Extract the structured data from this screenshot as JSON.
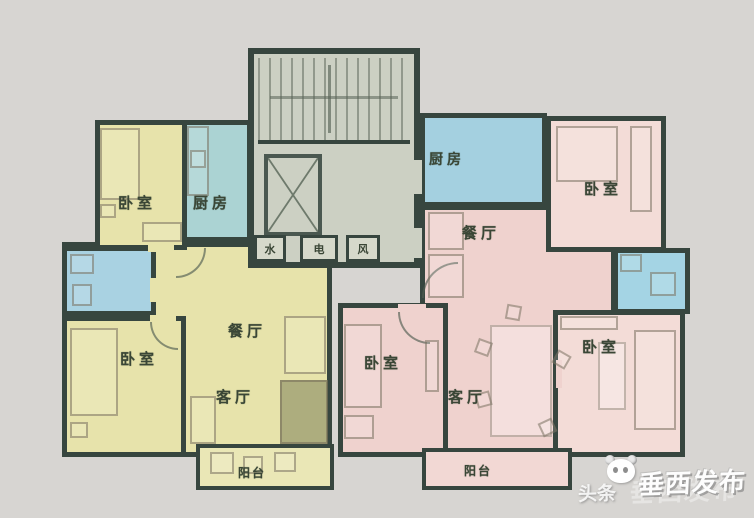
{
  "floorplan": {
    "left_unit": {
      "bedroom_top": "卧室",
      "kitchen": "厨房",
      "bedroom_main": "卧室",
      "dining": "餐厅",
      "living": "客厅",
      "balcony": "阳台"
    },
    "right_unit": {
      "kitchen": "厨房",
      "bedroom_top": "卧室",
      "dining": "餐厅",
      "bedroom_left": "卧室",
      "living": "客厅",
      "bedroom_bottom": "卧室",
      "balcony": "阳台"
    },
    "core": {
      "shaft_water": "水",
      "shaft_electric": "电",
      "shaft_air": "风"
    },
    "watermark": {
      "source": "头条",
      "logo": "panda-icon",
      "name": "垂西发布"
    },
    "colors": {
      "background": "#d7d5d2",
      "wall": "#37463f",
      "left_unit_fill": "#e7e3ab",
      "right_unit_fill": "#efd2ce",
      "wet_room_fill": "#a9d2e2",
      "core_fill": "#ccd0c3"
    }
  }
}
